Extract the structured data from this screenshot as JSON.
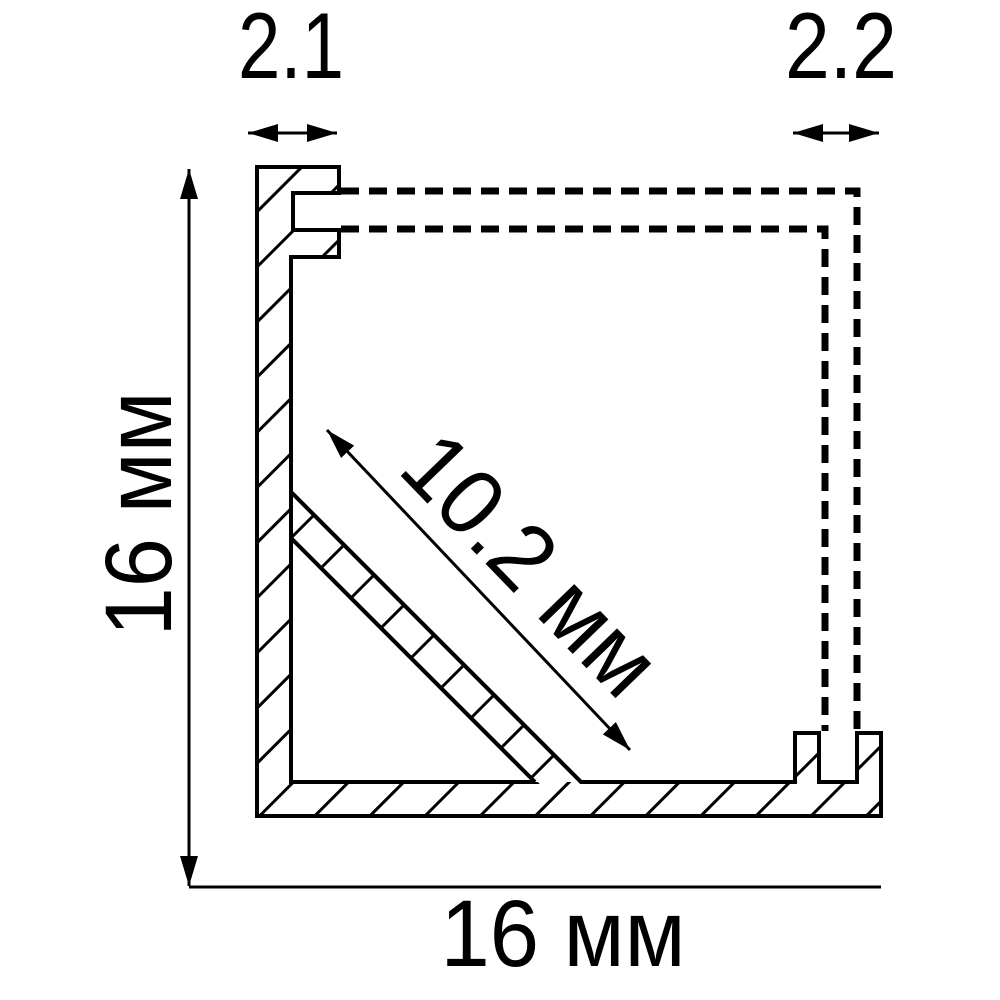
{
  "drawing": {
    "kind": "technical-cross-section",
    "colors": {
      "line": "#000000",
      "background": "#ffffff"
    },
    "labels": {
      "top_left": "2.1",
      "top_right": "2.2",
      "left_height": "16 мм",
      "bottom_width": "16 мм",
      "diagonal": "10.2 мм"
    }
  }
}
